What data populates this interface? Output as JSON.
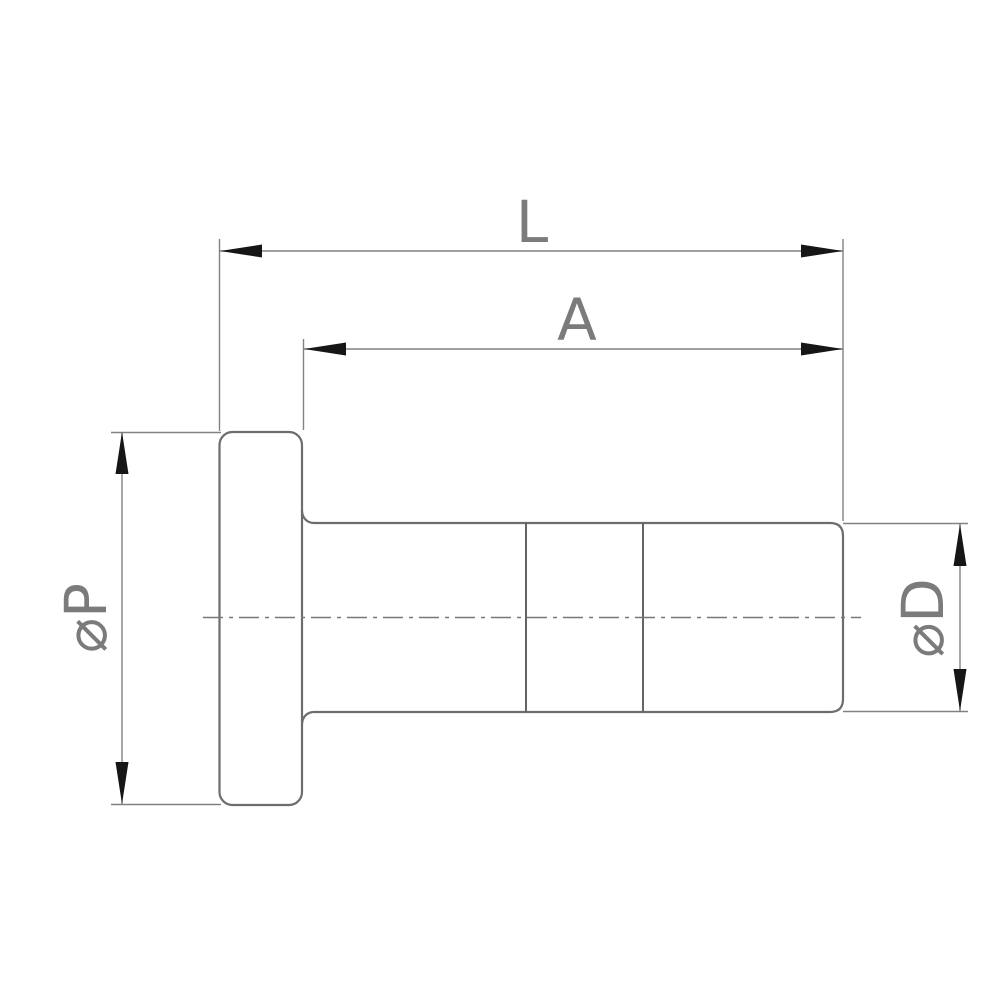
{
  "drawing": {
    "type": "technical-dimension-drawing",
    "subject": "flanged cylindrical plug, side view",
    "background_color": "#ffffff",
    "outline_color": "#6d6d6d",
    "dimension_line_color": "#828282",
    "arrow_color": "#161616",
    "label_color": "#7b7b7b",
    "labels": {
      "overall_length": "L",
      "body_length": "A",
      "flange_diameter": "⌀P",
      "body_diameter": "⌀D"
    }
  }
}
